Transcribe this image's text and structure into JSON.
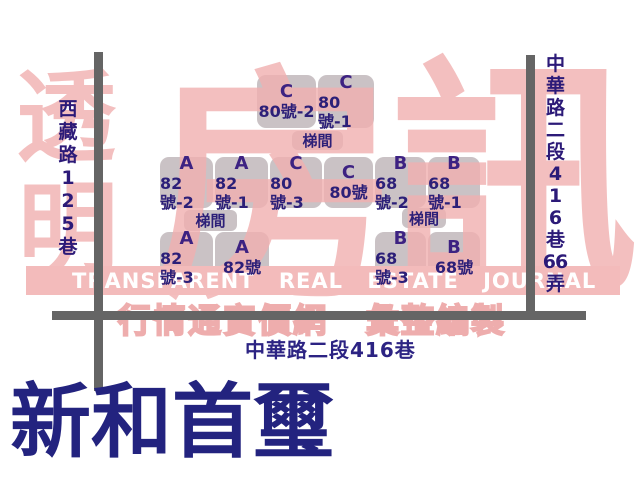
{
  "page": {
    "building_title": "新和首璽"
  },
  "watermark": {
    "glyph_1": "透",
    "glyph_2": "明",
    "glyph_3": "房",
    "glyph_4": "訊",
    "band_text": "TRANSPARENT REAL ESTATE JOURNAL",
    "subtitle_left": "行情通實價網",
    "subtitle_right": "彙整編製"
  },
  "streets": {
    "left_label": "西藏路125巷",
    "left_lines": [
      "西",
      "藏",
      "路",
      "1",
      "2",
      "5",
      "巷"
    ],
    "right_label": "中華路二段416巷66弄",
    "right_lines": [
      "中",
      "華",
      "路",
      "二",
      "段",
      "4",
      "1",
      "6",
      "巷",
      "66",
      "弄"
    ],
    "bottom_label": "中華路二段416巷"
  },
  "stairwell_label": "梯間",
  "units": [
    {
      "letter": "C",
      "number": "80號-2"
    },
    {
      "letter": "C",
      "number": "80號-1"
    },
    {
      "letter": "A",
      "number": "82號-2"
    },
    {
      "letter": "A",
      "number": "82號-1"
    },
    {
      "letter": "C",
      "number": "80號-3"
    },
    {
      "letter": "C",
      "number": "80號"
    },
    {
      "letter": "B",
      "number": "68號-2"
    },
    {
      "letter": "B",
      "number": "68號-1"
    },
    {
      "letter": "A",
      "number": "82號-3"
    },
    {
      "letter": "A",
      "number": "82號"
    },
    {
      "letter": "B",
      "number": "68號-3"
    },
    {
      "letter": "B",
      "number": "68號"
    }
  ],
  "colors": {
    "watermark_pink": "#f2b9b9",
    "box_gray": "#cac2c5",
    "road_gray": "#656565",
    "street_label_navy": "#2c1a78",
    "unit_text_navy": "#2c1f78",
    "title_navy": "#23237f"
  }
}
